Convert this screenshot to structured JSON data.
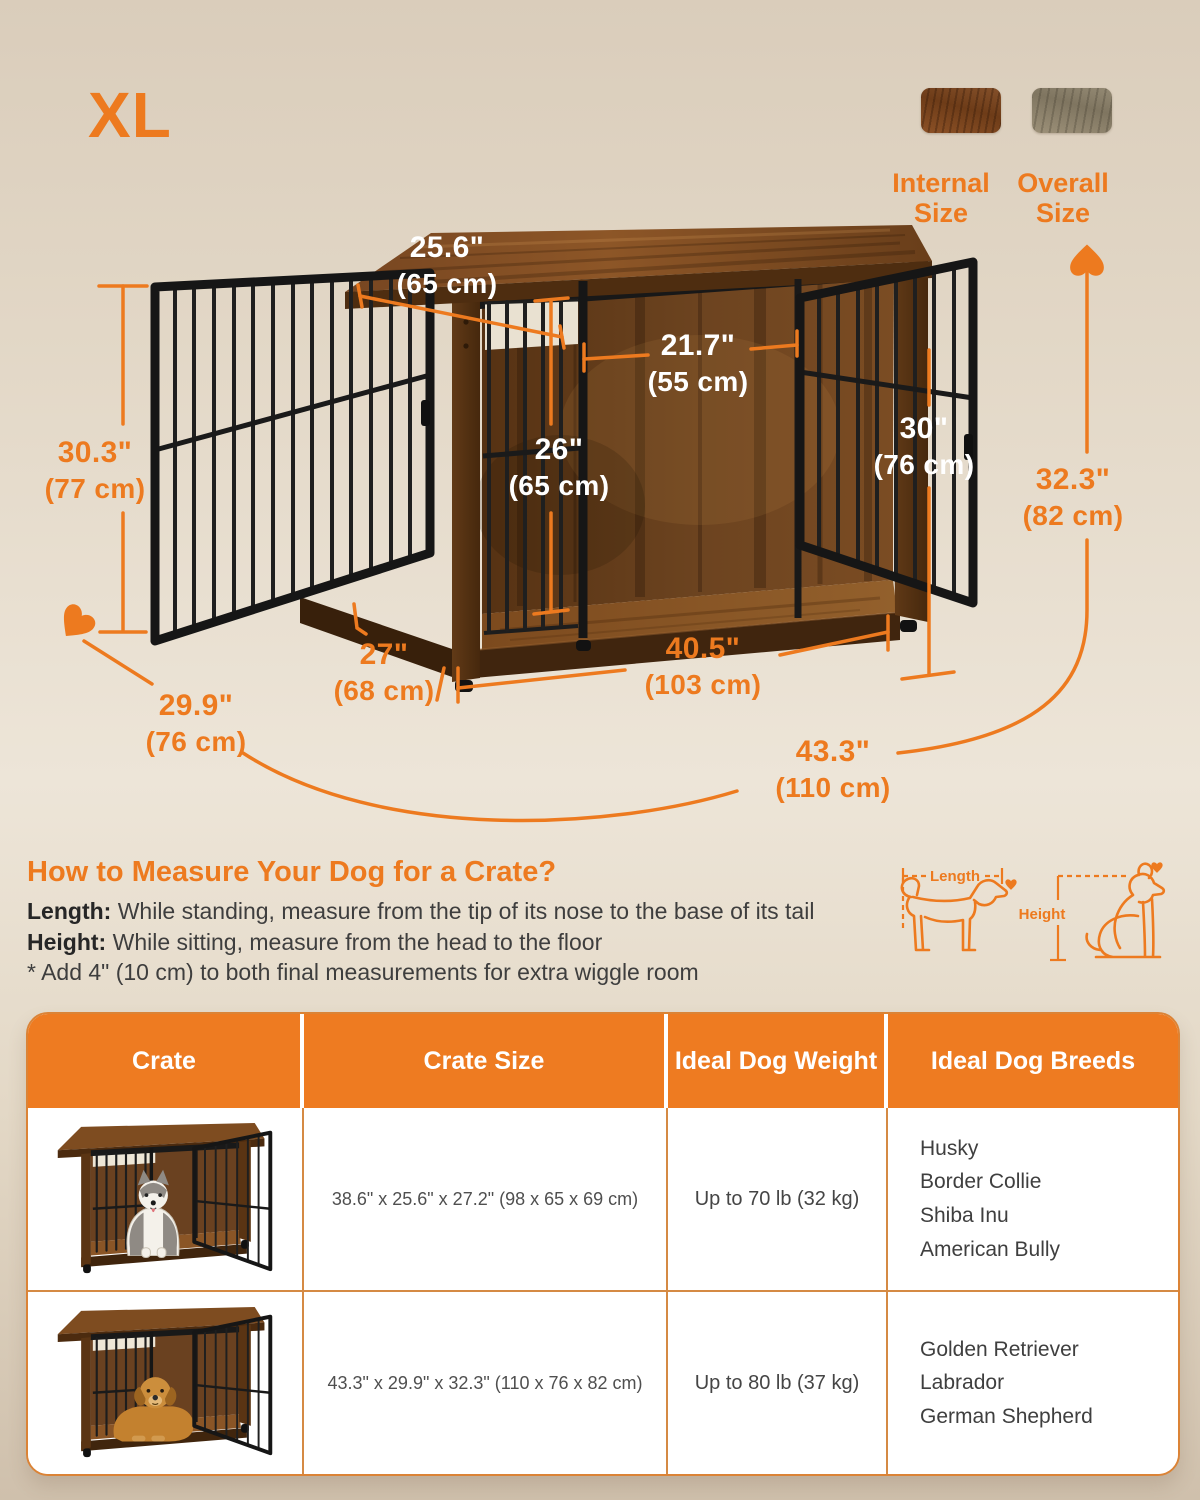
{
  "badge": "XL",
  "legend": {
    "internal_label": "Internal Size",
    "overall_label": "Overall Size"
  },
  "dimensions": {
    "top_depth": {
      "in": "25.6\"",
      "cm": "(65 cm)"
    },
    "door_width": {
      "in": "21.7\"",
      "cm": "(55 cm)"
    },
    "inner_height": {
      "in": "26\"",
      "cm": "(65 cm)"
    },
    "door_height": {
      "in": "30\"",
      "cm": "(76 cm)"
    },
    "side_height": {
      "in": "30.3\"",
      "cm": "(77 cm)"
    },
    "overall_height": {
      "in": "32.3\"",
      "cm": "(82 cm)"
    },
    "bottom_depth": {
      "in": "27\"",
      "cm": "(68 cm)"
    },
    "inner_width": {
      "in": "40.5\"",
      "cm": "(103 cm)"
    },
    "overall_depth": {
      "in": "29.9\"",
      "cm": "(76 cm)"
    },
    "overall_width": {
      "in": "43.3\"",
      "cm": "(110 cm)"
    }
  },
  "measure_guide": {
    "title": "How to Measure Your Dog for a Crate?",
    "length_label": "Length:",
    "length_text": "  While standing, measure from the tip of its nose to the base of its tail",
    "height_label": "Height:",
    "height_text": " While sitting, measure from the head to the floor",
    "note": "* Add 4\" (10 cm) to both final measurements for extra wiggle room",
    "diagram_length_label": "Length",
    "diagram_height_label": "Height"
  },
  "table": {
    "headers": [
      "Crate",
      "Crate Size",
      "Ideal Dog Weight",
      "Ideal Dog Breeds"
    ],
    "rows": [
      {
        "size": "38.6\" x 25.6\" x 27.2\" (98 x 65 x 69 cm)",
        "weight": "Up to 70 lb (32 kg)",
        "breeds": [
          "Husky",
          "Border Collie",
          "Shiba Inu",
          "American Bully"
        ]
      },
      {
        "size": "43.3\" x 29.9\" x 32.3\" (110 x 76 x 82 cm)",
        "weight": "Up to 80 lb (37 kg)",
        "breeds": [
          "Golden Retriever",
          "Labrador",
          "German Shepherd"
        ]
      }
    ]
  },
  "colors": {
    "accent": "#ED7A1F",
    "table_header": "#EE7B21",
    "rustic_wood": "#6E4220",
    "greige_wood": "#8E8269",
    "background": "#E5DACA"
  }
}
